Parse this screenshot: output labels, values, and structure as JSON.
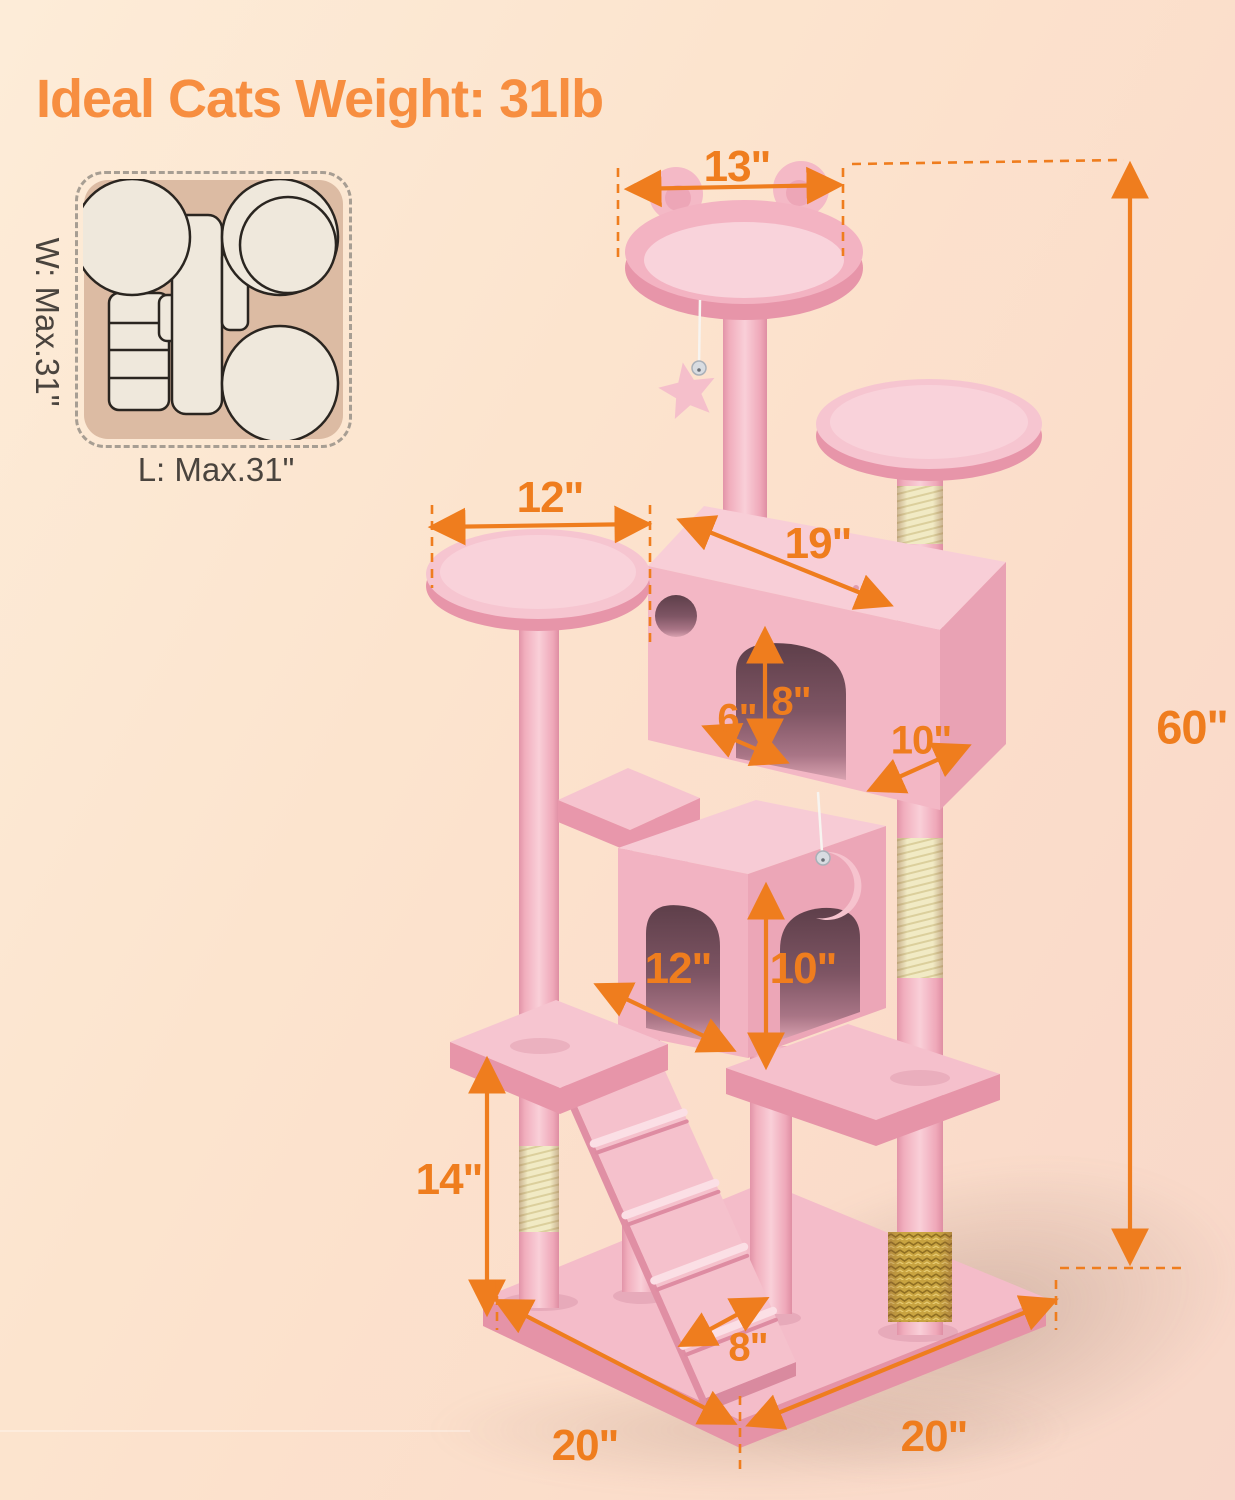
{
  "title": "Ideal Cats Weight: 31lb",
  "inset": {
    "width_label": "W: Max.31\"",
    "length_label": "L: Max.31\""
  },
  "dims": {
    "top_perch_width": "13\"",
    "left_perch_width": "12\"",
    "condo_length": "19\"",
    "door_height": "8\"",
    "entry_gap": "6\"",
    "condo_depth": "10\"",
    "total_height": "60\"",
    "mid_platform_span": "12\"",
    "lower_condo_height": "10\"",
    "lower_post_height": "14\"",
    "ramp_width": "8\"",
    "base_depth": "20\"",
    "base_width": "20\""
  },
  "colors": {
    "accent_orange": "#EF7D1E",
    "title_orange": "#F78E40",
    "tree_pink": "#F5BFC9",
    "sisal_cream": "#F0E8C0",
    "brush_gold": "#C9A440",
    "inset_tan": "#DCBBA3",
    "background_peach": "#FCE4CE",
    "outline_dark": "#2A2520"
  }
}
